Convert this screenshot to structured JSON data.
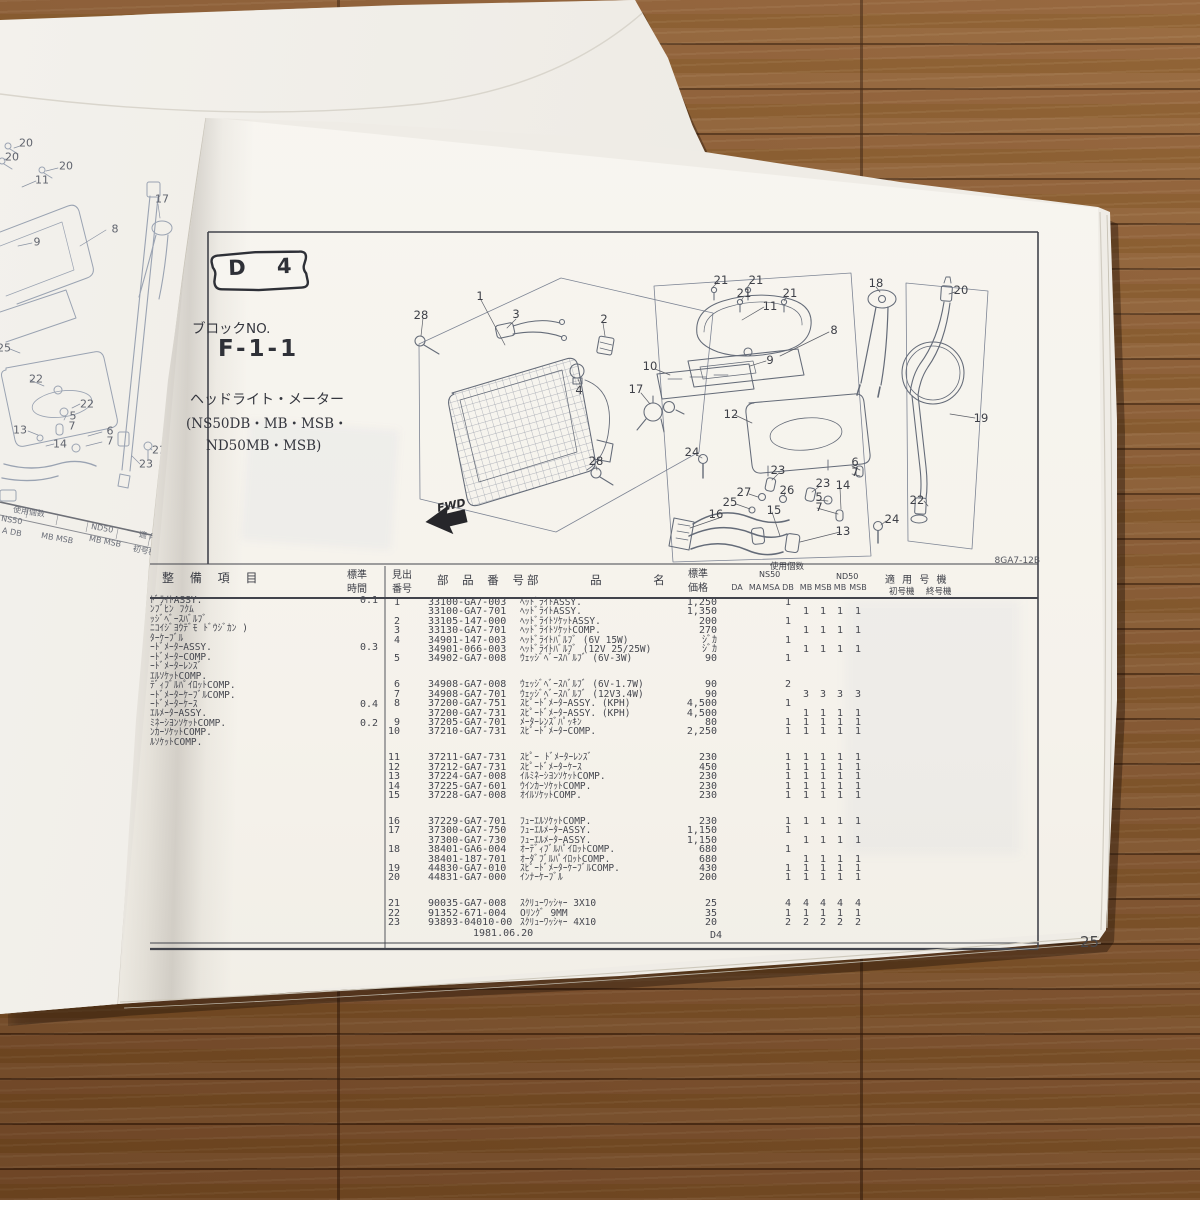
{
  "photo": {
    "page_number": "25",
    "doc_code": "8GA7-12B"
  },
  "header_block": {
    "badge": "D 4",
    "block_no_label": "ブロックNO.",
    "block_no": "F-1-1",
    "title": "ヘッドライト・メーター",
    "models_line1": "(NS50DB・MB・MSB・",
    "models_line2": "ND50MB・MSB)"
  },
  "diagram": {
    "fwd_label": "FWD",
    "callouts": [
      {
        "t": "28",
        "x": 421,
        "y": 315
      },
      {
        "t": "1",
        "x": 480,
        "y": 296
      },
      {
        "t": "3",
        "x": 516,
        "y": 314
      },
      {
        "t": "2",
        "x": 604,
        "y": 319
      },
      {
        "t": "4",
        "x": 579,
        "y": 390
      },
      {
        "t": "28",
        "x": 596,
        "y": 461
      },
      {
        "t": "10",
        "x": 650,
        "y": 366
      },
      {
        "t": "17",
        "x": 636,
        "y": 389
      },
      {
        "t": "21",
        "x": 721,
        "y": 280
      },
      {
        "t": "21",
        "x": 756,
        "y": 280
      },
      {
        "t": "21",
        "x": 744,
        "y": 293
      },
      {
        "t": "21",
        "x": 790,
        "y": 293
      },
      {
        "t": "11",
        "x": 770,
        "y": 306
      },
      {
        "t": "8",
        "x": 834,
        "y": 330
      },
      {
        "t": "9",
        "x": 770,
        "y": 360
      },
      {
        "t": "12",
        "x": 731,
        "y": 414
      },
      {
        "t": "18",
        "x": 876,
        "y": 283
      },
      {
        "t": "20",
        "x": 961,
        "y": 290
      },
      {
        "t": "19",
        "x": 981,
        "y": 418
      },
      {
        "t": "22",
        "x": 917,
        "y": 500
      },
      {
        "t": "24",
        "x": 692,
        "y": 452
      },
      {
        "t": "24",
        "x": 892,
        "y": 519
      },
      {
        "t": "23",
        "x": 778,
        "y": 470
      },
      {
        "t": "23",
        "x": 823,
        "y": 483
      },
      {
        "t": "27",
        "x": 744,
        "y": 492
      },
      {
        "t": "26",
        "x": 787,
        "y": 490
      },
      {
        "t": "25",
        "x": 730,
        "y": 502
      },
      {
        "t": "16",
        "x": 716,
        "y": 514
      },
      {
        "t": "15",
        "x": 774,
        "y": 510
      },
      {
        "t": "6",
        "x": 855,
        "y": 462
      },
      {
        "t": "7",
        "x": 855,
        "y": 472
      },
      {
        "t": "14",
        "x": 843,
        "y": 485
      },
      {
        "t": "5",
        "x": 819,
        "y": 497
      },
      {
        "t": "7",
        "x": 819,
        "y": 507
      },
      {
        "t": "13",
        "x": 843,
        "y": 531
      }
    ]
  },
  "left_page": {
    "callouts": [
      {
        "t": "20",
        "x": 26,
        "y": 143
      },
      {
        "t": "20",
        "x": 12,
        "y": 157
      },
      {
        "t": "20",
        "x": 66,
        "y": 166
      },
      {
        "t": "11",
        "x": 42,
        "y": 180
      },
      {
        "t": "9",
        "x": 37,
        "y": 242
      },
      {
        "t": "8",
        "x": 115,
        "y": 229
      },
      {
        "t": "17",
        "x": 162,
        "y": 199
      },
      {
        "t": "25",
        "x": 4,
        "y": 348
      },
      {
        "t": "22",
        "x": 36,
        "y": 379
      },
      {
        "t": "22",
        "x": 87,
        "y": 404
      },
      {
        "t": "5",
        "x": 73,
        "y": 416
      },
      {
        "t": "7",
        "x": 72,
        "y": 426
      },
      {
        "t": "13",
        "x": 20,
        "y": 430
      },
      {
        "t": "14",
        "x": 60,
        "y": 444
      },
      {
        "t": "6",
        "x": 110,
        "y": 431
      },
      {
        "t": "7",
        "x": 110,
        "y": 441
      },
      {
        "t": "23",
        "x": 146,
        "y": 464
      },
      {
        "t": "21",
        "x": 159,
        "y": 450
      }
    ],
    "fragments": [
      {
        "t": "使用個数",
        "x": 14,
        "y": 504,
        "r": 9
      },
      {
        "t": "NS50",
        "x": 2,
        "y": 514,
        "r": 9
      },
      {
        "t": "A DB",
        "x": 3,
        "y": 526,
        "r": 10
      },
      {
        "t": "MB MSB",
        "x": 42,
        "y": 531,
        "r": 10
      },
      {
        "t": "ND50",
        "x": 92,
        "y": 522,
        "r": 10
      },
      {
        "t": "MB MSB",
        "x": 90,
        "y": 534,
        "r": 11
      },
      {
        "t": "適 用",
        "x": 140,
        "y": 529,
        "r": 11
      },
      {
        "t": "初号機",
        "x": 134,
        "y": 543,
        "r": 12
      }
    ]
  },
  "table": {
    "headers": {
      "service": "整 備 項 目",
      "std_time_1": "標準",
      "std_time_2": "時間",
      "ref_1": "見出",
      "ref_2": "番号",
      "part_no": "部 品 番 号",
      "part_name": "部 品 名",
      "price_1": "標準",
      "price_2": "価格",
      "qty_group": "使用個数",
      "ns50": "NS50",
      "nd50": "ND50",
      "qty_cols": [
        "DA",
        "MA",
        "MSA",
        "DB",
        "MB",
        "MSB",
        "MB",
        "MSB"
      ],
      "apply": "適 用 号 機",
      "apply_first": "初号機",
      "apply_last": "終号機"
    },
    "service_items": [
      {
        "text": "ﾄﾞﾗｲﾄASSY.",
        "time": "0.1"
      },
      {
        "text": "ﾝﾌﾞﾋﾝ ﾌｸﾑ",
        "time": ""
      },
      {
        "text": "ｯｼﾞﾍﾞｰｽﾊﾞﾙﾌﾞ",
        "time": ""
      },
      {
        "text": "ﾆｺｲｼﾞﾖｳﾃﾞﾓ ﾄﾞｳｼﾞｶﾝ )",
        "time": ""
      },
      {
        "text": "ﾀｰｹｰﾌﾞﾙ",
        "time": ""
      },
      {
        "text": "ｰﾄﾞﾒｰﾀｰASSY.",
        "time": "0.3"
      },
      {
        "text": "ｰﾄﾞﾒｰﾀｰCOMP.",
        "time": ""
      },
      {
        "text": "ｰﾄﾞﾒｰﾀｰﾚﾝｽﾞ",
        "time": ""
      },
      {
        "text": "ｴﾙｿｹｯﾄCOMP.",
        "time": ""
      },
      {
        "text": "ﾃﾞｨﾌﾞﾙﾊﾟｲﾛｯﾄCOMP.",
        "time": ""
      },
      {
        "text": "ｰﾄﾞﾒｰﾀｰｹｰﾌﾞﾙCOMP.",
        "time": ""
      },
      {
        "text": "ｰﾄﾞﾒｰﾀｰｹｰｽ",
        "time": "0.4"
      },
      {
        "text": "ｴﾙﾒｰﾀｰASSY.",
        "time": ""
      },
      {
        "text": "ﾐﾈｰｼﾖﾝｿｹｯﾄCOMP.",
        "time": "0.2"
      },
      {
        "text": "ﾝｶｰｿｹｯﾄCOMP.",
        "time": ""
      },
      {
        "text": "ﾙｿｹｯﾄCOMP.",
        "time": ""
      }
    ],
    "rows": [
      {
        "no": "1",
        "part_no": "33100-GA7-003",
        "name": "ﾍｯﾄﾞﾗｲﾄASSY.",
        "price": "1,250",
        "qty": [
          "",
          "",
          "",
          "1",
          "",
          "",
          "",
          ""
        ]
      },
      {
        "no": "",
        "part_no": "33100-GA7-701",
        "name": "ﾍｯﾄﾞﾗｲﾄASSY.",
        "price": "1,350",
        "qty": [
          "",
          "",
          "",
          "",
          "1",
          "1",
          "1",
          "1"
        ]
      },
      {
        "no": "2",
        "part_no": "33105-147-000",
        "name": "ﾍｯﾄﾞﾗｲﾄｿｹｯﾄASSY.",
        "price": "200",
        "qty": [
          "",
          "",
          "",
          "1",
          "",
          "",
          "",
          ""
        ]
      },
      {
        "no": "3",
        "part_no": "33130-GA7-701",
        "name": "ﾍｯﾄﾞﾗｲﾄｿｹｯﾄCOMP.",
        "price": "270",
        "qty": [
          "",
          "",
          "",
          "",
          "1",
          "1",
          "1",
          "1"
        ]
      },
      {
        "no": "4",
        "part_no": "34901-147-003",
        "name": "ﾍｯﾄﾞﾗｲﾄﾊﾞﾙﾌﾞ (6V 15W)",
        "price": "ｼﾞｶ",
        "qty": [
          "",
          "",
          "",
          "1",
          "",
          "",
          "",
          ""
        ]
      },
      {
        "no": "",
        "part_no": "34901-066-003",
        "name": "ﾍｯﾄﾞﾗｲﾄﾊﾞﾙﾌﾞ (12V 25/25W)",
        "price": "ｼﾞｶ",
        "qty": [
          "",
          "",
          "",
          "",
          "1",
          "1",
          "1",
          "1"
        ]
      },
      {
        "no": "5",
        "part_no": "34902-GA7-008",
        "name": "ｳｪｯｼﾞﾍﾞｰｽﾊﾞﾙﾌﾞ (6V-3W)",
        "price": "90",
        "qty": [
          "",
          "",
          "",
          "1",
          "",
          "",
          "",
          ""
        ]
      },
      {
        "no": "6",
        "part_no": "34908-GA7-008",
        "name": "ｳｪｯｼﾞﾍﾞｰｽﾊﾞﾙﾌﾞ (6V-1.7W)",
        "price": "90",
        "qty": [
          "",
          "",
          "",
          "2",
          "",
          "",
          "",
          ""
        ],
        "gap": true
      },
      {
        "no": "7",
        "part_no": "34908-GA7-701",
        "name": "ｳｪｯｼﾞﾍﾞｰｽﾊﾞﾙﾌﾞ (12V3.4W)",
        "price": "90",
        "qty": [
          "",
          "",
          "",
          "",
          "3",
          "3",
          "3",
          "3"
        ]
      },
      {
        "no": "8",
        "part_no": "37200-GA7-751",
        "name": "ｽﾋﾟｰﾄﾞﾒｰﾀｰASSY. (KPH)",
        "price": "4,500",
        "qty": [
          "",
          "",
          "",
          "1",
          "",
          "",
          "",
          ""
        ]
      },
      {
        "no": "",
        "part_no": "37200-GA7-731",
        "name": "ｽﾋﾟｰﾄﾞﾒｰﾀｰASSY. (KPH)",
        "price": "4,500",
        "qty": [
          "",
          "",
          "",
          "",
          "1",
          "1",
          "1",
          "1"
        ]
      },
      {
        "no": "9",
        "part_no": "37205-GA7-701",
        "name": "ﾒｰﾀｰﾚﾝｽﾞﾊﾟｯｷﾝ",
        "price": "80",
        "qty": [
          "",
          "",
          "",
          "1",
          "1",
          "1",
          "1",
          "1"
        ]
      },
      {
        "no": "10",
        "part_no": "37210-GA7-731",
        "name": "ｽﾋﾟｰﾄﾞﾒｰﾀｰCOMP.",
        "price": "2,250",
        "qty": [
          "",
          "",
          "",
          "1",
          "1",
          "1",
          "1",
          "1"
        ]
      },
      {
        "no": "11",
        "part_no": "37211-GA7-731",
        "name": "ｽﾋﾟｰ ﾄﾞﾒｰﾀｰﾚﾝｽﾞ",
        "price": "230",
        "qty": [
          "",
          "",
          "",
          "1",
          "1",
          "1",
          "1",
          "1"
        ],
        "gap": true
      },
      {
        "no": "12",
        "part_no": "37212-GA7-731",
        "name": "ｽﾋﾟｰﾄﾞﾒｰﾀｰｹｰｽ",
        "price": "450",
        "qty": [
          "",
          "",
          "",
          "1",
          "1",
          "1",
          "1",
          "1"
        ]
      },
      {
        "no": "13",
        "part_no": "37224-GA7-008",
        "name": "ｲﾙﾐﾈｰｼﾖﾝｿｹｯﾄCOMP.",
        "price": "230",
        "qty": [
          "",
          "",
          "",
          "1",
          "1",
          "1",
          "1",
          "1"
        ]
      },
      {
        "no": "14",
        "part_no": "37225-GA7-601",
        "name": "ｳｲﾝｶｰｿｹｯﾄCOMP.",
        "price": "230",
        "qty": [
          "",
          "",
          "",
          "1",
          "1",
          "1",
          "1",
          "1"
        ]
      },
      {
        "no": "15",
        "part_no": "37228-GA7-008",
        "name": "ｵｲﾙｿｹｯﾄCOMP.",
        "price": "230",
        "qty": [
          "",
          "",
          "",
          "1",
          "1",
          "1",
          "1",
          "1"
        ]
      },
      {
        "no": "16",
        "part_no": "37229-GA7-701",
        "name": "ﾌｭｰｴﾙｿｹｯﾄCOMP.",
        "price": "230",
        "qty": [
          "",
          "",
          "",
          "1",
          "1",
          "1",
          "1",
          "1"
        ],
        "gap": true
      },
      {
        "no": "17",
        "part_no": "37300-GA7-750",
        "name": "ﾌｭｰｴﾙﾒｰﾀｰASSY.",
        "price": "1,150",
        "qty": [
          "",
          "",
          "",
          "1",
          "",
          "",
          "",
          ""
        ]
      },
      {
        "no": "",
        "part_no": "37300-GA7-730",
        "name": "ﾌｭｰｴﾙﾒｰﾀｰASSY.",
        "price": "1,150",
        "qty": [
          "",
          "",
          "",
          "",
          "1",
          "1",
          "1",
          "1"
        ]
      },
      {
        "no": "18",
        "part_no": "38401-GA6-004",
        "name": "ｵｰﾃﾞｨﾌﾞﾙﾊﾟｲﾛｯﾄCOMP.",
        "price": "680",
        "qty": [
          "",
          "",
          "",
          "1",
          "",
          "",
          "",
          ""
        ]
      },
      {
        "no": "",
        "part_no": "38401-187-701",
        "name": "ｵｰﾀﾞﾌﾞﾙﾊﾟｲﾛｯﾄCOMP.",
        "price": "680",
        "qty": [
          "",
          "",
          "",
          "",
          "1",
          "1",
          "1",
          "1"
        ]
      },
      {
        "no": "19",
        "part_no": "44830-GA7-010",
        "name": "ｽﾋﾟｰﾄﾞﾒｰﾀｰｹｰﾌﾞﾙCOMP.",
        "price": "430",
        "qty": [
          "",
          "",
          "",
          "1",
          "1",
          "1",
          "1",
          "1"
        ]
      },
      {
        "no": "20",
        "part_no": "44831-GA7-000",
        "name": "ｲﾝﾅｰｹｰﾌﾞﾙ",
        "price": "200",
        "qty": [
          "",
          "",
          "",
          "1",
          "1",
          "1",
          "1",
          "1"
        ]
      },
      {
        "no": "21",
        "part_no": "90035-GA7-008",
        "name": "ｽｸﾘｭｰﾜｯｼｬｰ 3X10",
        "price": "25",
        "qty": [
          "",
          "",
          "",
          "4",
          "4",
          "4",
          "4",
          "4"
        ],
        "gap": true
      },
      {
        "no": "22",
        "part_no": "91352-671-004",
        "name": "Oﾘﾝｸﾞ 9MM",
        "price": "35",
        "qty": [
          "",
          "",
          "",
          "1",
          "1",
          "1",
          "1",
          "1"
        ]
      },
      {
        "no": "23",
        "part_no": "93893-04010-00",
        "name": "ｽｸﾘｭｰﾜｯｼｬｰ 4X10",
        "price": "20",
        "qty": [
          "",
          "",
          "",
          "2",
          "2",
          "2",
          "2",
          "2"
        ]
      }
    ],
    "footer_date": "1981.06.20",
    "footer_block": "D4"
  }
}
